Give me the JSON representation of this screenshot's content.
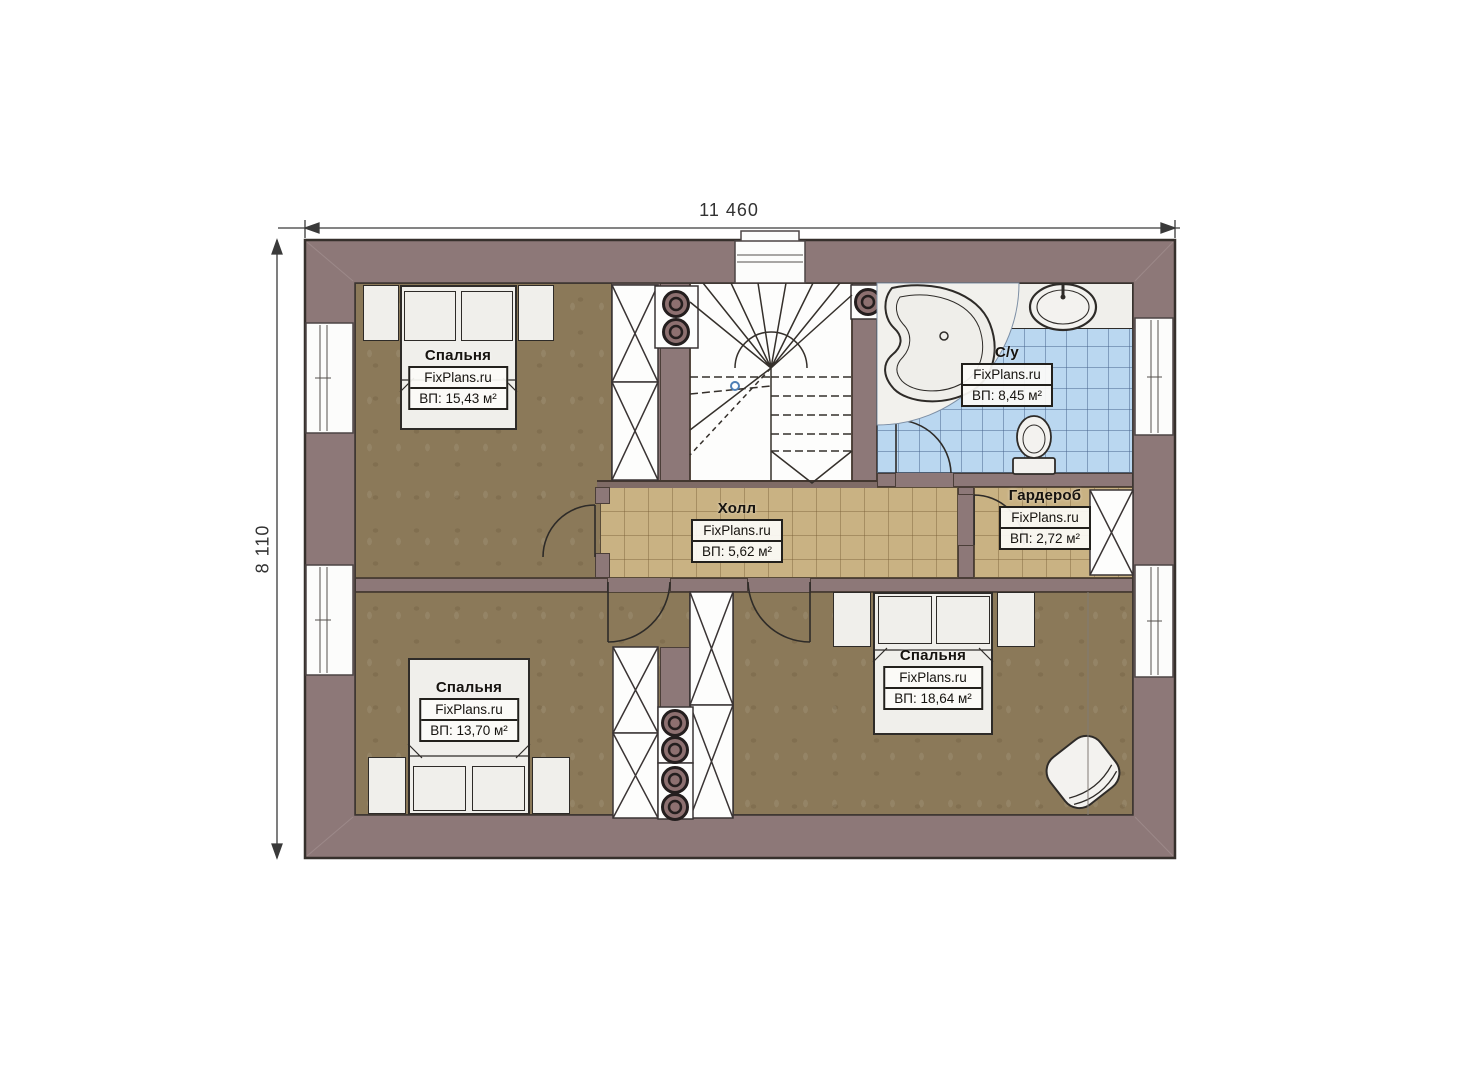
{
  "page": {
    "background": "#ffffff",
    "type": "floor-plan"
  },
  "dimensions": {
    "width": "11 460",
    "height": "8 110"
  },
  "rooms": [
    {
      "key": "bedroom-top-left",
      "name": "Спальня",
      "brand": "FixPlans.ru",
      "area": "ВП: 15,43 м²"
    },
    {
      "key": "bathroom",
      "name": "С/у",
      "brand": "FixPlans.ru",
      "area": "ВП: 8,45 м²"
    },
    {
      "key": "hall",
      "name": "Холл",
      "brand": "FixPlans.ru",
      "area": "ВП: 5,62 м²"
    },
    {
      "key": "wardrobe",
      "name": "Гардероб",
      "brand": "FixPlans.ru",
      "area": "ВП: 2,72 м²"
    },
    {
      "key": "bedroom-bottom-left",
      "name": "Спальня",
      "brand": "FixPlans.ru",
      "area": "ВП: 13,70 м²"
    },
    {
      "key": "bedroom-bottom-right",
      "name": "Спальня",
      "brand": "FixPlans.ru",
      "area": "ВП: 18,64 м²"
    }
  ],
  "colors": {
    "wall": "#8d7878",
    "bedroom_floor": "#8b7959",
    "hall_floor": "#c9b283",
    "bath_floor": "#bad7f0",
    "fixture": "#f0efeb",
    "outline": "#2e2b28"
  }
}
